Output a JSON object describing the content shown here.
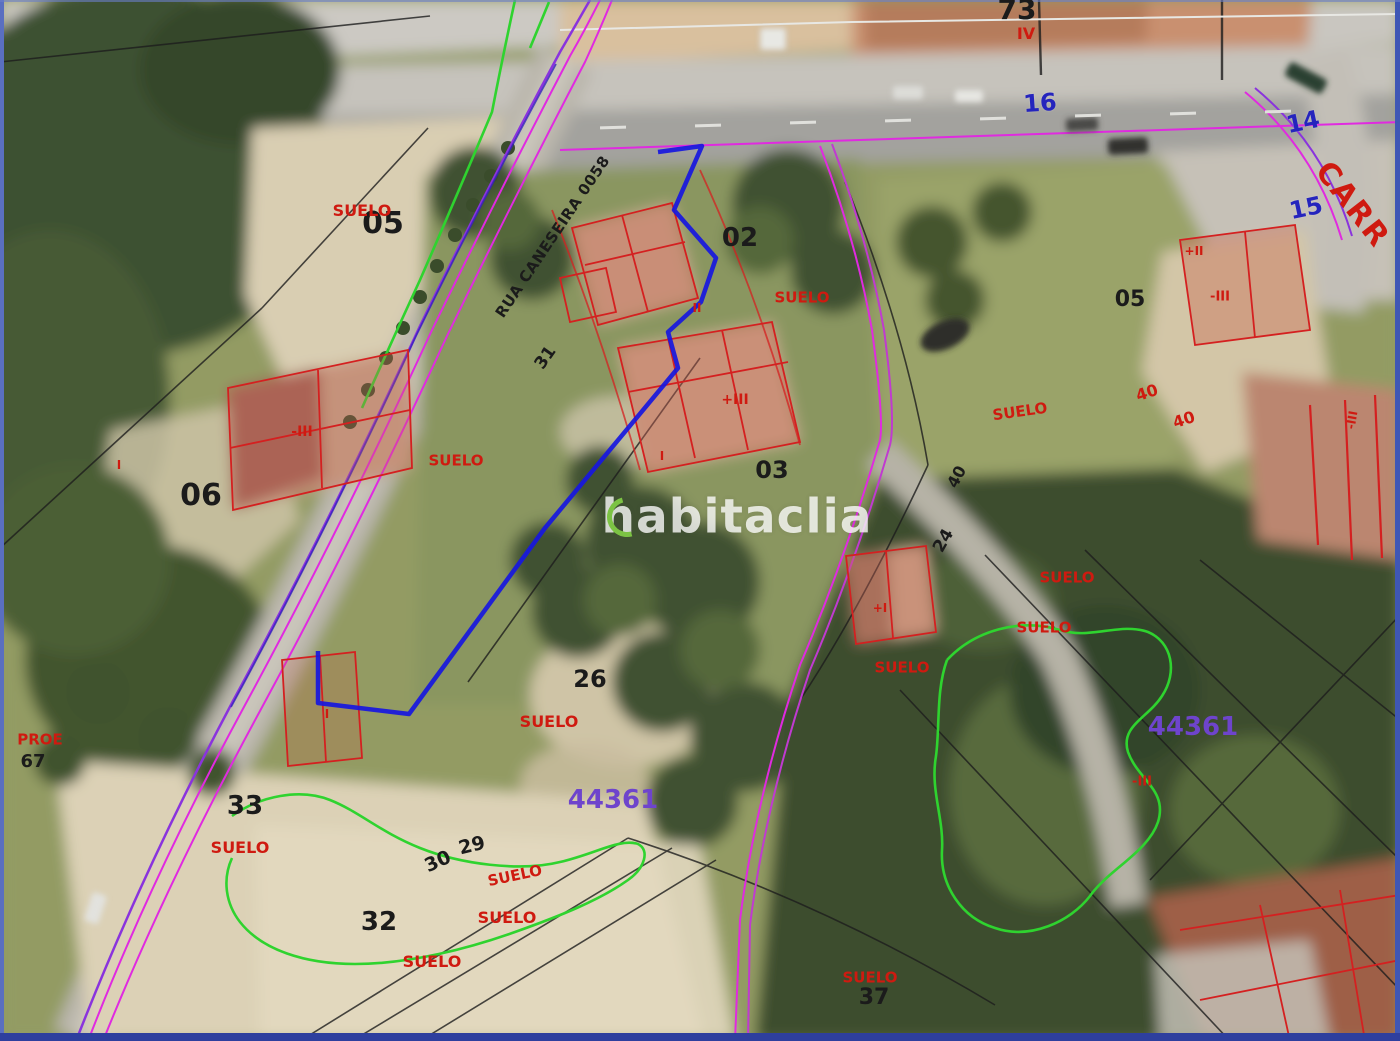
{
  "watermark": {
    "text": "habitaclia"
  },
  "street": {
    "name": "RUA CANESEIRA 0058"
  },
  "colors": {
    "parcel_highlight_blue": "#1717df",
    "cadastral_red": "#d42020",
    "boundary_magenta": "#e02ae0",
    "boundary_purple": "#8a33dd",
    "boundary_green": "#2fd32f",
    "label_blue": "#2524bd",
    "label_purple": "#6e44cc",
    "watermark_green": "#7cc344"
  },
  "labels": {
    "k73": {
      "text": "73"
    },
    "k05a": {
      "text": "05"
    },
    "k02": {
      "text": "02"
    },
    "k31": {
      "text": "31"
    },
    "k06": {
      "text": "06"
    },
    "k03": {
      "text": "03"
    },
    "k05b": {
      "text": "05"
    },
    "k40b": {
      "text": "40"
    },
    "k24": {
      "text": "24"
    },
    "k26": {
      "text": "26"
    },
    "k33": {
      "text": "33"
    },
    "k29": {
      "text": "29"
    },
    "k30": {
      "text": "30"
    },
    "k32": {
      "text": "32"
    },
    "k37": {
      "text": "37"
    },
    "k67": {
      "text": "67"
    },
    "k16": {
      "text": "16"
    },
    "k14": {
      "text": "14"
    },
    "k15": {
      "text": "15"
    },
    "k44361a": {
      "text": "44361"
    },
    "k44361b": {
      "text": "44361"
    },
    "kIV": {
      "text": "IV"
    },
    "kCARR": {
      "text": "CARR"
    },
    "su05": {
      "text": "SUELO"
    },
    "suA": {
      "text": "SUELO"
    },
    "suB": {
      "text": "SUELO"
    },
    "suC": {
      "text": "SUELO"
    },
    "suD": {
      "text": "SUELO"
    },
    "suE": {
      "text": "SUELO"
    },
    "suF": {
      "text": "SUELO"
    },
    "suG": {
      "text": "SUELO"
    },
    "suH": {
      "text": "SUELO"
    },
    "suI": {
      "text": "SUELO"
    },
    "suJ": {
      "text": "SUELO"
    },
    "suK": {
      "text": "SUELO"
    },
    "suL": {
      "text": "SUELO"
    },
    "kPROE": {
      "text": "PROE"
    },
    "r40a": {
      "text": "40"
    },
    "r40c": {
      "text": "40"
    },
    "fm3a": {
      "text": "-III"
    },
    "fp3": {
      "text": "+III"
    },
    "f2": {
      "text": "II"
    },
    "f1a": {
      "text": "I"
    },
    "fm3b": {
      "text": "-III"
    },
    "fp2": {
      "text": "+II"
    },
    "fp1": {
      "text": "+I"
    },
    "f1b": {
      "text": "I"
    },
    "f1c": {
      "text": "I"
    },
    "fm3c": {
      "text": "-III"
    },
    "fm3d": {
      "text": "-III"
    }
  }
}
